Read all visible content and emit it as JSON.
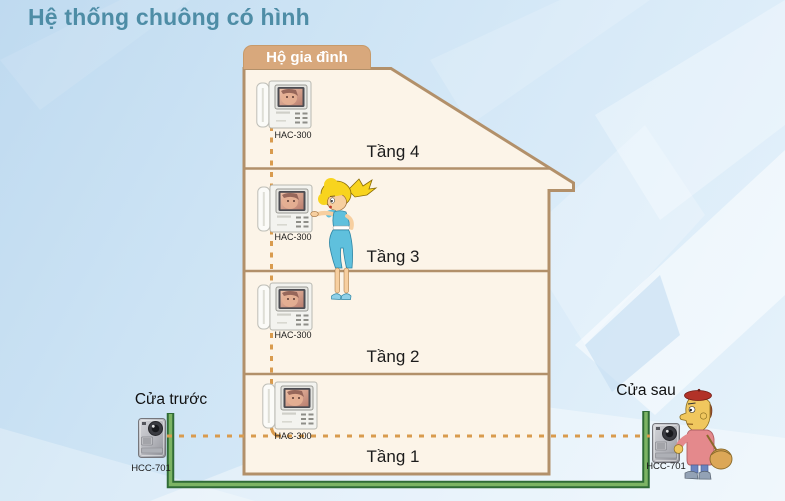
{
  "title": "Hệ thống chuông có hình",
  "household": {
    "label": "Hộ gia đình"
  },
  "floors": [
    {
      "label": "Tầng 4",
      "device_label": "HAC-300"
    },
    {
      "label": "Tầng 3",
      "device_label": "HAC-300"
    },
    {
      "label": "Tầng 2",
      "device_label": "HAC-300"
    },
    {
      "label": "Tầng 1",
      "device_label": "HAC-300"
    }
  ],
  "front_door": {
    "label": "Cửa trước",
    "device_label": "HCC-701"
  },
  "back_door": {
    "label": "Cửa sau",
    "device_label": "HCC-701"
  },
  "colors": {
    "title_text": "#4e8da6",
    "household_box": "#d8a87c",
    "building_fill": "#fcf4e8",
    "building_outline": "#b2906a",
    "wire_dashed": "#d99b4e",
    "wire_green_dark": "#2f6b36",
    "wire_green_light": "#7cb464"
  }
}
